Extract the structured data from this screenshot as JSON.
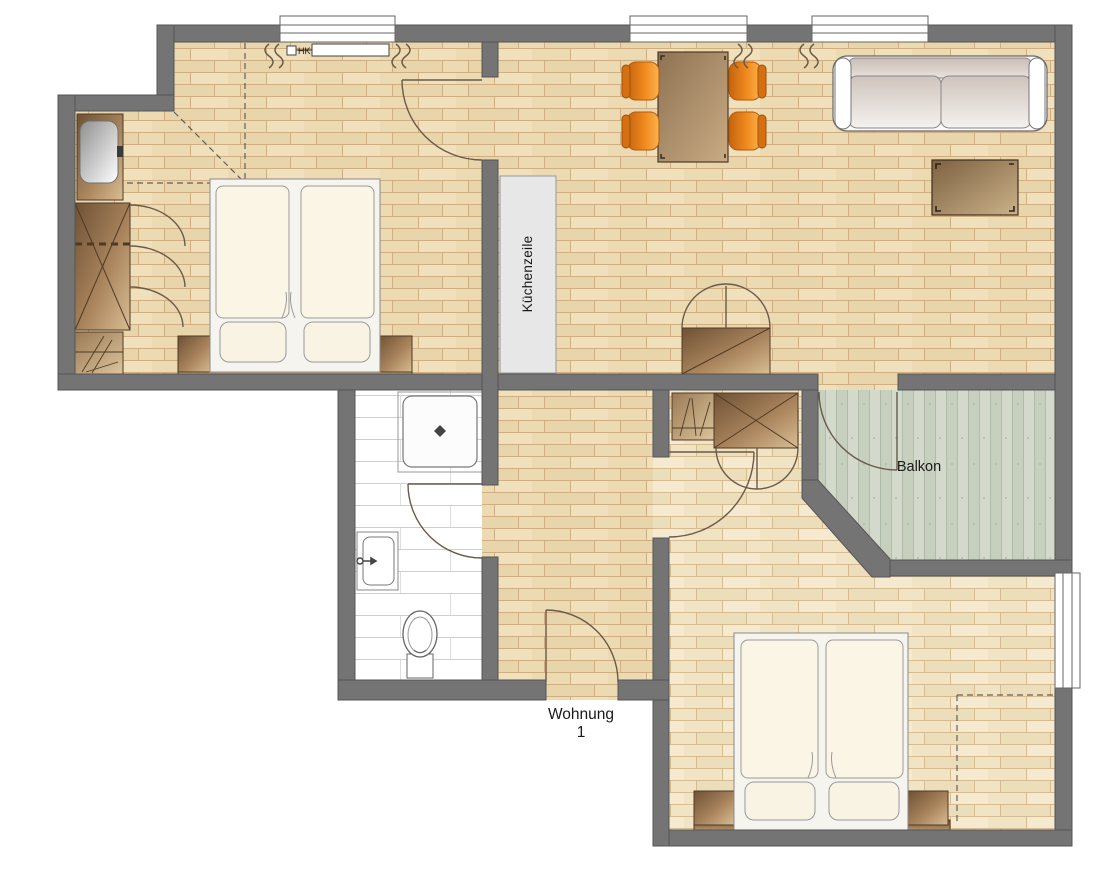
{
  "labels": {
    "radiator": "HK",
    "kitchen_unit": "Küchenzeile",
    "balcony": "Balkon",
    "apartment_line1": "Wohnung",
    "apartment_line2": "1"
  },
  "colors": {
    "wall": "#747474",
    "wall_outline": "#555555",
    "wood_floor": "#ecdab2",
    "wood_floor_line": "#cfae82",
    "wood_floor_light": "#f1e4c4",
    "wood_floor_light_line": "#d6bb90",
    "balcony_floor": "#d3d9cb",
    "balcony_stripe": "#c7cfbf",
    "bathroom_tile_line": "#cfcfcf",
    "furniture_brown_dark": "#6e5134",
    "furniture_brown_light": "#d9bd92",
    "chair_orange": "#f08a1e",
    "bed_linen": "#faf5e5",
    "sofa_fabric": "#cfc4bd",
    "door_arc": "#6a5a48",
    "text": "#1a1a1a"
  }
}
